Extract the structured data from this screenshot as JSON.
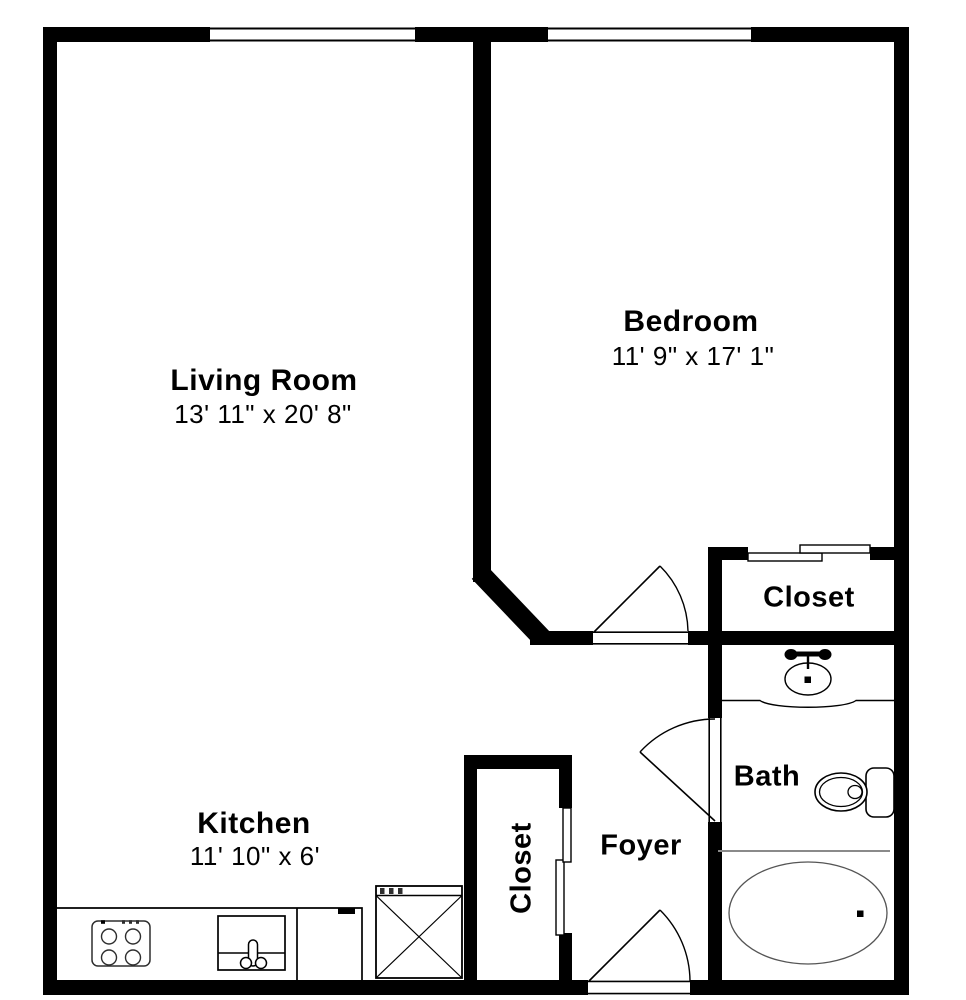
{
  "title": "Apartment floor plan",
  "colors": {
    "wall": "#000000",
    "background": "#ffffff",
    "fixture_line": "#2e2e2e",
    "soft_line": "#555555",
    "divider_gray": "#8a8a8a"
  },
  "rooms": {
    "living_room": {
      "label": "Living Room",
      "dimensions": "13' 11\" x 20' 8\""
    },
    "bedroom": {
      "label": "Bedroom",
      "dimensions": "11' 9\" x 17' 1\""
    },
    "kitchen": {
      "label": "Kitchen",
      "dimensions": "11' 10\" x 6'"
    },
    "bath": {
      "label": "Bath"
    },
    "foyer": {
      "label": "Foyer"
    },
    "bedroom_closet": {
      "label": "Closet"
    },
    "foyer_closet": {
      "label": "Closet"
    }
  },
  "fixtures": [
    "stove-icon",
    "kitchen-sink-icon",
    "dishwasher-icon",
    "refrigerator-icon",
    "bathroom-sink-icon",
    "toilet-icon",
    "bathtub-icon"
  ],
  "doors": [
    "entry-door",
    "bedroom-door",
    "bath-door"
  ],
  "windows": [
    "living-room-window",
    "bedroom-window"
  ]
}
